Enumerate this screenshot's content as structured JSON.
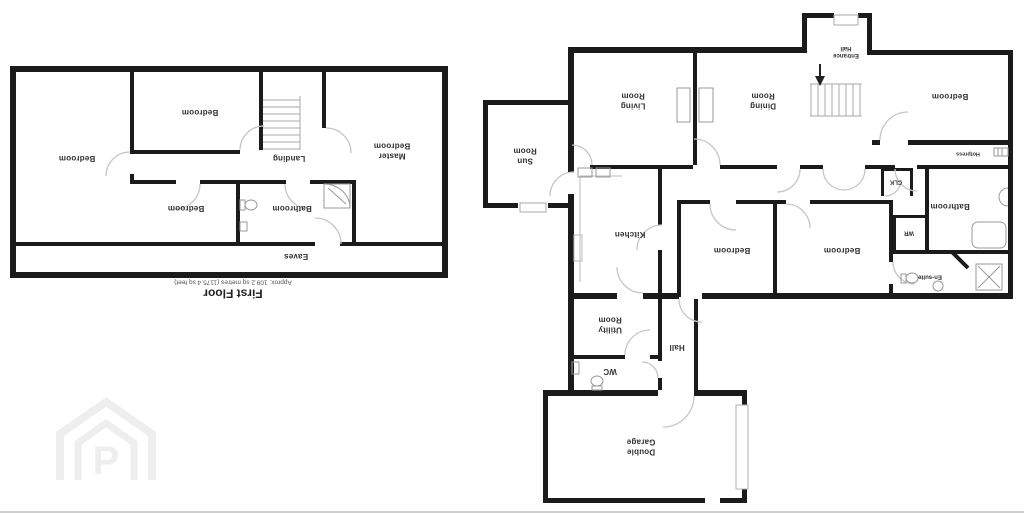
{
  "plans": {
    "first_floor": {
      "title": "First Floor",
      "area_text": "Approx. 109.2 sq metres (1175.4 sq feet)",
      "rooms": {
        "bedroom_left": "Bedroom",
        "bedroom_top": "Bedroom",
        "landing": "Landing",
        "master_bedroom": "Master\nBedroom",
        "bedroom_bottom": "Bedroom",
        "bathroom": "Bathroom",
        "eaves": "Eaves"
      }
    },
    "ground_floor": {
      "rooms": {
        "sun_room": "Sun\nRoom",
        "living_room": "Living\nRoom",
        "dining_room": "Dining\nRoom",
        "entrance_hall": "Entrance\nHall",
        "bedroom_top_right": "Bedroom",
        "hotpress": "Hotpress",
        "clk": "CLK",
        "bathroom": "Bathroom",
        "wr": "WR",
        "en_suite": "En-suite",
        "kitchen": "Kitchen",
        "bedroom_center": "Bedroom",
        "bedroom_right": "Bedroom",
        "utility_room": "Utility\nRoom",
        "hall": "Hall",
        "wc": "WC",
        "double_garage": "Double\nGarage"
      }
    }
  },
  "watermark": {
    "letter": "P"
  },
  "icons": {
    "stairs_down_arrow": "↓"
  },
  "colors": {
    "wall": "#1b1b1b",
    "door_arc": "#c6c6c6",
    "fixture": "#9a9a9a",
    "label": "#2f2f2f",
    "watermark": "#eeeeee",
    "background": "#ffffff"
  }
}
